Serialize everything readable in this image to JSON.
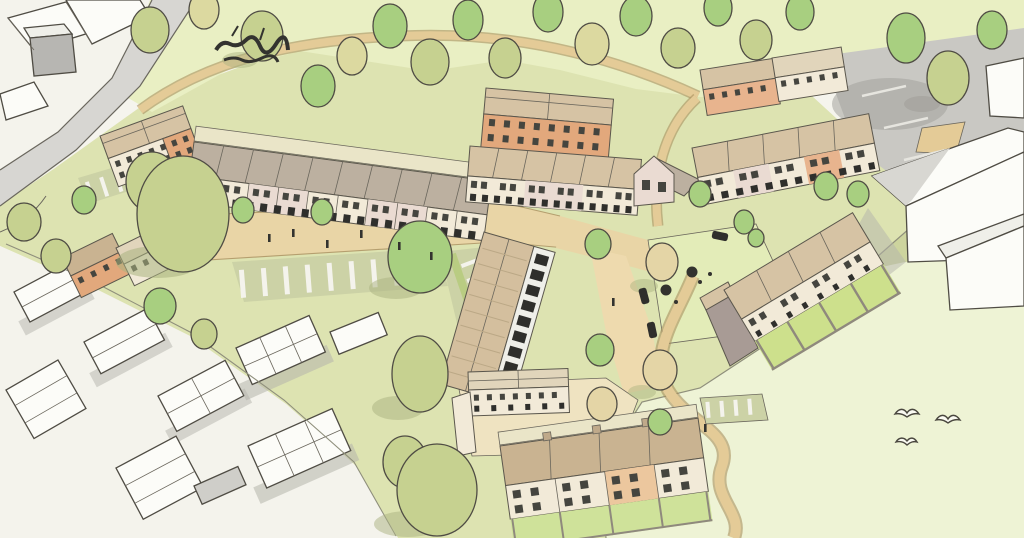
{
  "palette": {
    "paper": "#f5f4ed",
    "zoneWhite": "#f4f3ec",
    "fieldTop": "#e9efc3",
    "fieldSide": "#eef3d5",
    "devGround": "#dde3b1",
    "oliveBand": "#cdd49e",
    "roadGray": "#d7d6d2",
    "parkingGray": "#c9c8c3",
    "parkingShadow": "#a3a29c",
    "streetTan": "#e9d5a6",
    "laneTan": "#eedaae",
    "pathTan": "#e4cb97",
    "courtGreen": "#e3ecb8",
    "courtTan": "#efe3c1",
    "bayGreen": "#ccd2a6",
    "lawnGreen": "#cde08c",
    "gardenGreen": "#cfe29a",
    "hedge": "#b9cc82",
    "roofGray": "#bcb0a0",
    "roofTan": "#d6c3a4",
    "roofBrown": "#c9b391",
    "roofBarn": "#d4bf9e",
    "roofLight": "#e1d5bb",
    "wallCream": "#f2ead8",
    "wallPink": "#eadbd2",
    "wallOrange": "#e2a87c",
    "wallPeach": "#e8b48e",
    "wallOrangeLight": "#ecc79e",
    "gableGray": "#a89b95",
    "rearBand": "#eae5c8",
    "whiteBldg": "#fcfcf8",
    "whiteShade": "#efefe9",
    "roofShadow": "#d8d7d2",
    "groundShadow": "#b4b4ac",
    "cubeGray": "#b7b6b2",
    "garageGray": "#cfcec9",
    "treeOlive": "#c6d190",
    "treeGreen": "#a8cf80",
    "treeYellow": "#dcd9a0",
    "treeBeige": "#e4d5a6",
    "treeShadow": "#a9b27f",
    "shadowOnGray": "#9d9c96",
    "dark": "#33332f",
    "window": "#45453f",
    "doorDark": "#2f2f2c",
    "birdFill": "#fafaf2",
    "curb": "#6a675e",
    "wallLine": "#8f897d",
    "rafter": "#bba886",
    "chimney": "#bfa98a"
  }
}
